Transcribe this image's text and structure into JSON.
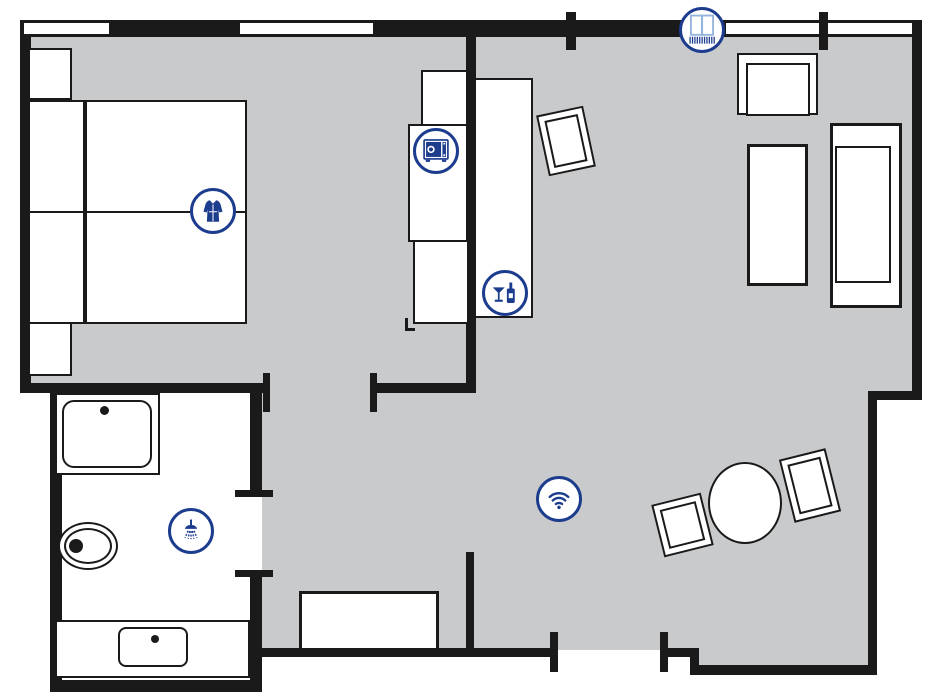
{
  "document": {
    "type_label": "hotel-room-floor-plan"
  },
  "colors": {
    "wall": "#1a1a1a",
    "floor": "#c9cacc",
    "accent": "#1c3c8e",
    "accent_light": "#93b4dc",
    "background": "#ffffff"
  },
  "amenity_icons": [
    {
      "name": "bathrobe-icon"
    },
    {
      "name": "safe-icon"
    },
    {
      "name": "minibar-icon"
    },
    {
      "name": "balcony-door-icon"
    },
    {
      "name": "shower-icon"
    },
    {
      "name": "wifi-icon"
    }
  ],
  "rooms": [
    {
      "name": "bedroom"
    },
    {
      "name": "living-area"
    },
    {
      "name": "bathroom"
    },
    {
      "name": "hallway"
    }
  ],
  "furniture_symbols": [
    {
      "name": "double-bed"
    },
    {
      "name": "nightstand"
    },
    {
      "name": "wardrobe"
    },
    {
      "name": "sideboard"
    },
    {
      "name": "tv"
    },
    {
      "name": "armchair"
    },
    {
      "name": "lounger"
    },
    {
      "name": "sofa"
    },
    {
      "name": "dining-table"
    },
    {
      "name": "chair"
    },
    {
      "name": "bench"
    },
    {
      "name": "washbasin"
    },
    {
      "name": "toilet"
    },
    {
      "name": "bathtub"
    }
  ]
}
